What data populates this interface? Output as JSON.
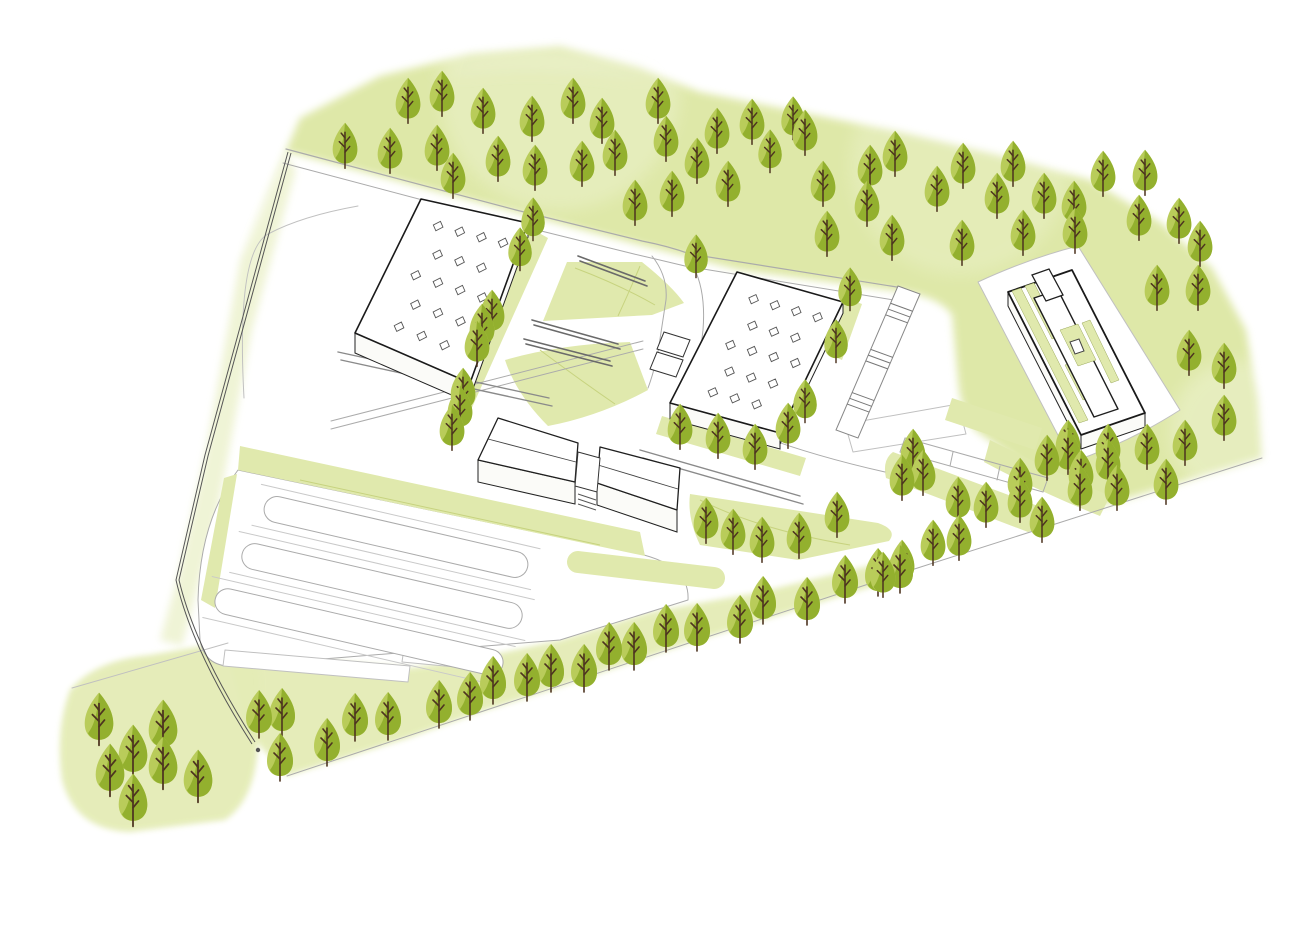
{
  "meta": {
    "kind": "architectural-site-plan",
    "view": "axonometric-illustration"
  },
  "canvas": {
    "w": 1310,
    "h": 931
  },
  "colors": {
    "bg": "#ffffff",
    "wash_deep": "#dde7a4",
    "wash_mid": "#e4ecb6",
    "wash_pale": "#eef3d2",
    "lawn": "#e0e9ad",
    "lawn_line": "#c7d37f",
    "tree_light": "#b9cc5a",
    "tree_dark": "#93b02e",
    "trunk": "#4d3420",
    "roof_outline": "#1a1a1a",
    "detail_outline": "#555555",
    "curb": "#ababab",
    "faint": "#c0c0c0",
    "platform": "#8a8a8a",
    "seat": "#6a6a6a",
    "guardrail": "#555555",
    "wall_fill": "#fbfbf8",
    "white": "#ffffff"
  },
  "washes": [
    {
      "d": "M288,152 L515,212 L640,245 L740,270 L905,292 Q940,298 952,315 L958,380 Q960,410 975,430 L1030,470 L1105,505 L1262,458 L1258,400 L1246,330 L1212,268 L1160,222 L1090,180 L1010,158 L900,132 L780,108 L700,92 L640,68 L560,46 L470,54 L380,76 L300,118 L240,258 Z",
      "fill": "wash_deep",
      "blur": "blur4",
      "op": 0.95
    },
    {
      "d": "M286,156 L240,260 L205,455 L178,575 L160,640 L182,646 L216,520 L252,330 L296,170 Z",
      "fill": "wash_pale",
      "blur": "blur4",
      "op": 0.9
    },
    {
      "d": "M227,652 L410,668 L478,658 L560,640 L650,612 L760,592 L905,557 L900,578 L695,641 L550,690 L480,712 L408,738 L287,776 L250,735 Z",
      "fill": "wash_mid",
      "blur": "blur3",
      "op": 0.95
    },
    {
      "d": "M70,690 Q95,660 150,655 L225,642 Q258,648 260,680 L258,745 Q255,800 225,820 L130,832 Q75,830 62,780 Q55,730 70,690 Z",
      "fill": "wash_mid",
      "blur": "blur3",
      "op": 0.95
    },
    {
      "d": "M430,70 Q560,40 660,80 Q560,60 470,70 Z",
      "fill": "wash_pale",
      "blur": "blur8",
      "op": 0.6
    }
  ],
  "soft_lights": [
    {
      "cx": 560,
      "cy": 90,
      "r": 120,
      "op": 0.22
    },
    {
      "cx": 960,
      "cy": 165,
      "r": 110,
      "op": 0.18
    },
    {
      "cx": 1240,
      "cy": 430,
      "r": 70,
      "op": 0.25
    }
  ],
  "white_areas": [
    {
      "d": "M238,470 L640,554 Q690,566 688,600 L560,640 L235,666 Q205,668 200,640 L198,600 Q200,520 238,470 Z",
      "stroke": "curb"
    },
    {
      "d": "M978,282 Q1030,258 1078,246 L1180,410 Q1130,442 1072,462 Z",
      "stroke": "faint"
    },
    {
      "d": "M845,424 L958,404 L966,434 L853,452 Z",
      "stroke": "faint"
    },
    {
      "d": "M225,650 L410,666 L408,682 L223,666 Z",
      "stroke": "faint"
    },
    {
      "d": "M404,648 L468,654 L466,668 L402,662 Z",
      "stroke": "faint"
    }
  ],
  "lawns": [
    {
      "d": "M567,262 L642,262 Q672,286 684,303 L652,315 L543,321 Z"
    },
    {
      "d": "M505,360 Q560,344 630,342 L648,390 Q600,416 548,426 Q516,394 505,360 Z"
    },
    {
      "d": "M690,494 L878,523 Q898,530 889,541 L798,560 L700,545 Q687,518 690,494 Z"
    },
    {
      "d": "M240,446 L640,532 L645,556 L238,470 Z"
    },
    {
      "d": "M237,474 L215,608 L201,600 L224,478 Z"
    },
    {
      "d": "M893,452 L1038,506 Q1052,513 1046,526 L1028,532 L886,478 Q882,460 893,452 Z"
    },
    {
      "d": "M952,398 L1042,428 L1035,450 L945,420 Z"
    },
    {
      "d": "M990,440 Q1050,470 1110,496 L1100,516 Q1040,492 984,462 Z"
    },
    {
      "d": "M530,228 L548,238 L470,412 L452,440 L444,432 L462,398 Z"
    },
    {
      "d": "M662,416 L806,458 L800,476 L656,434 Z"
    },
    {
      "d": "M846,298 L862,304 L842,360 L828,354 Z"
    }
  ],
  "lawn_lines": [
    {
      "d": "M575,268 Q620,285 655,305"
    },
    {
      "d": "M640,266 Q630,290 618,316"
    },
    {
      "d": "M540,350 Q580,380 615,404"
    },
    {
      "d": "M700,500 Q760,530 850,545"
    },
    {
      "d": "M300,480 L600,545"
    }
  ],
  "capsules": [
    {
      "x1": 578,
      "y1": 562,
      "x2": 714,
      "y2": 578,
      "w": 22
    }
  ],
  "parking": {
    "angle": 13,
    "islands": [
      {
        "cx": 396,
        "cy": 537,
        "len": 270,
        "w": 26
      },
      {
        "cx": 382,
        "cy": 586,
        "len": 287,
        "w": 26
      },
      {
        "cx": 359,
        "cy": 632,
        "len": 295,
        "w": 26
      }
    ],
    "aux_offset": 21
  },
  "lines": [
    {
      "d": "M286,149 L516,210 L642,241 Q668,246 690,254 L903,288",
      "c": "curb",
      "w": 1.2
    },
    {
      "d": "M283,163 L513,224 L634,254 Q660,260 685,266 L900,301",
      "c": "curb",
      "w": 1
    },
    {
      "d": "M652,256 Q668,276 666,300 L658,352 Q654,372 648,388",
      "c": "curb",
      "w": 1
    },
    {
      "d": "M694,268 Q706,292 703,330 L698,372 Q696,392 700,408",
      "c": "curb",
      "w": 1
    },
    {
      "d": "M703,410 Q770,446 885,472",
      "c": "curb",
      "w": 1
    },
    {
      "d": "M244,398 Q236,252 268,234 Q302,216 358,206",
      "c": "faint",
      "w": 1
    },
    {
      "d": "M331,421 L643,341",
      "c": "curb",
      "w": 1
    },
    {
      "d": "M331,429 L643,349",
      "c": "curb",
      "w": 1
    },
    {
      "d": "M287,776 L695,641 L905,572 L1262,458",
      "c": "curb",
      "w": 1
    },
    {
      "d": "M72,688 L228,643",
      "c": "faint",
      "w": 1
    },
    {
      "d": "M905,438 L1048,478",
      "c": "curb",
      "w": 1
    },
    {
      "d": "M900,452 L1043,492",
      "c": "curb",
      "w": 1
    },
    {
      "d": "M905,438 L900,452",
      "c": "curb",
      "w": 1
    },
    {
      "d": "M1048,478 L1043,492",
      "c": "curb",
      "w": 1
    },
    {
      "d": "M953,452 L950,466",
      "c": "curb",
      "w": 1
    },
    {
      "d": "M1000,466 L997,480",
      "c": "curb",
      "w": 1
    },
    {
      "d": "M338,352 L549,398",
      "c": "platform",
      "w": 1.4
    },
    {
      "d": "M341,360 L552,406",
      "c": "platform",
      "w": 1.4
    },
    {
      "d": "M640,450 L800,496",
      "c": "platform",
      "w": 1.4
    },
    {
      "d": "M643,458 L803,504",
      "c": "platform",
      "w": 1.4
    },
    {
      "d": "M578,256 L645,281",
      "c": "seat",
      "w": 1.6
    },
    {
      "d": "M580,261 L647,286",
      "c": "seat",
      "w": 1.6
    },
    {
      "d": "M532,320 L618,344",
      "c": "seat",
      "w": 1.6
    },
    {
      "d": "M534,325 L620,349",
      "c": "seat",
      "w": 1.6
    },
    {
      "d": "M524,339 L610,361",
      "c": "seat",
      "w": 1.6
    },
    {
      "d": "M526,344 L612,366",
      "c": "seat",
      "w": 1.6
    }
  ],
  "guardrail": {
    "paths": [
      "M288,152 L205,455 L176,580 Q192,650 252,744",
      "M291,153 L208,456 L179,580 Q195,648 255,742"
    ],
    "dot": [
      258,
      750
    ]
  },
  "ramp": {
    "quad": [
      [
        898,
        286
      ],
      [
        920,
        294
      ],
      [
        858,
        438
      ],
      [
        836,
        430
      ]
    ],
    "treads": [
      0.12,
      0.16,
      0.2,
      0.44,
      0.48,
      0.52,
      0.74,
      0.78,
      0.82
    ]
  },
  "buildings": {
    "sky_uv": [
      [
        0.25,
        0.15
      ],
      [
        0.45,
        0.15
      ],
      [
        0.65,
        0.15
      ],
      [
        0.85,
        0.15
      ],
      [
        0.35,
        0.33
      ],
      [
        0.55,
        0.33
      ],
      [
        0.75,
        0.33
      ],
      [
        0.25,
        0.5
      ],
      [
        0.45,
        0.5
      ],
      [
        0.65,
        0.5
      ],
      [
        0.85,
        0.5
      ],
      [
        0.35,
        0.68
      ],
      [
        0.55,
        0.68
      ],
      [
        0.75,
        0.68
      ],
      [
        0.3,
        0.85
      ],
      [
        0.5,
        0.85
      ],
      [
        0.7,
        0.85
      ]
    ],
    "hall_left": {
      "quad": [
        [
          421,
          199
        ],
        [
          528,
          223
        ],
        [
          470,
          383
        ],
        [
          355,
          333
        ]
      ],
      "wall": 20
    },
    "hall_middle": {
      "quad": [
        [
          737,
          272
        ],
        [
          843,
          302
        ],
        [
          780,
          433
        ],
        [
          670,
          403
        ]
      ],
      "wall": 16
    },
    "annexes": [
      [
        [
          664,
          332
        ],
        [
          690,
          340
        ],
        [
          683,
          357
        ],
        [
          657,
          349
        ]
      ],
      [
        [
          657,
          352
        ],
        [
          683,
          360
        ],
        [
          676,
          377
        ],
        [
          650,
          369
        ]
      ]
    ],
    "sheds": [
      {
        "roof": [
          [
            498,
            418
          ],
          [
            578,
            443
          ],
          [
            575,
            482
          ],
          [
            478,
            460
          ]
        ],
        "ridge": [
          [
            488,
            439
          ],
          [
            576,
            462
          ]
        ],
        "wall": 22
      },
      {
        "roof": [
          [
            600,
            447
          ],
          [
            680,
            468
          ],
          [
            677,
            510
          ],
          [
            597,
            483
          ]
        ],
        "ridge": [
          [
            598,
            465
          ],
          [
            678,
            489
          ]
        ],
        "wall": 22
      }
    ],
    "connector": {
      "quad": [
        [
          578,
          452
        ],
        [
          600,
          458
        ],
        [
          597,
          492
        ],
        [
          575,
          486
        ]
      ],
      "steps": [
        "M578,494 L596,500",
        "M578,499 L596,505",
        "M578,504 L596,510"
      ]
    },
    "right": {
      "outer": [
        [
          1008,
          292
        ],
        [
          1072,
          270
        ],
        [
          1145,
          413
        ],
        [
          1081,
          435
        ]
      ],
      "wall": 14,
      "strips": [
        [
          [
            1012,
            291
          ],
          [
            1021,
            288
          ],
          [
            1088,
            420
          ],
          [
            1079,
            423
          ]
        ],
        [
          [
            1025,
            286
          ],
          [
            1034,
            283
          ],
          [
            1061,
            336
          ],
          [
            1052,
            339
          ]
        ],
        [
          [
            1065,
            365
          ],
          [
            1074,
            362
          ],
          [
            1092,
            397
          ],
          [
            1083,
            400
          ]
        ],
        [
          [
            1044,
            290
          ],
          [
            1053,
            287
          ],
          [
            1066,
            313
          ],
          [
            1057,
            316
          ]
        ],
        [
          [
            1082,
            323
          ],
          [
            1090,
            320
          ],
          [
            1119,
            380
          ],
          [
            1111,
            383
          ]
        ]
      ],
      "volumes": [
        [
          [
            1034,
            298
          ],
          [
            1058,
            290
          ],
          [
            1118,
            409
          ],
          [
            1094,
            417
          ]
        ]
      ],
      "bar": [
        [
          1032,
          275
        ],
        [
          1049,
          269
        ],
        [
          1063,
          295
        ],
        [
          1046,
          301
        ]
      ],
      "unit": [
        [
          1070,
          342
        ],
        [
          1079,
          339
        ],
        [
          1084,
          351
        ],
        [
          1075,
          354
        ]
      ],
      "court": [
        [
          1060,
          330
        ],
        [
          1078,
          324
        ],
        [
          1096,
          360
        ],
        [
          1078,
          366
        ]
      ]
    }
  },
  "trees": {
    "items": [
      [
        345,
        155,
        0.95
      ],
      [
        390,
        160,
        0.95
      ],
      [
        408,
        110,
        0.95
      ],
      [
        437,
        157,
        0.95
      ],
      [
        442,
        103,
        0.95
      ],
      [
        453,
        185,
        0.95
      ],
      [
        483,
        120,
        0.95
      ],
      [
        498,
        168,
        0.95
      ],
      [
        532,
        128,
        0.95
      ],
      [
        535,
        177,
        0.95
      ],
      [
        573,
        110,
        0.95
      ],
      [
        582,
        173,
        0.95
      ],
      [
        602,
        130,
        0.95
      ],
      [
        615,
        162,
        0.95
      ],
      [
        635,
        212,
        0.95
      ],
      [
        658,
        110,
        0.95
      ],
      [
        666,
        148,
        0.95
      ],
      [
        672,
        203,
        0.95
      ],
      [
        697,
        170,
        0.95
      ],
      [
        717,
        140,
        0.95
      ],
      [
        728,
        193,
        0.95
      ],
      [
        752,
        131,
        0.95
      ],
      [
        770,
        160,
        0.9
      ],
      [
        793,
        127,
        0.9
      ],
      [
        805,
        142,
        0.95
      ],
      [
        823,
        193,
        0.95
      ],
      [
        827,
        243,
        0.95
      ],
      [
        867,
        213,
        0.95
      ],
      [
        870,
        177,
        0.95
      ],
      [
        892,
        247,
        0.95
      ],
      [
        895,
        163,
        0.95
      ],
      [
        937,
        198,
        0.95
      ],
      [
        962,
        252,
        0.95
      ],
      [
        963,
        175,
        0.95
      ],
      [
        997,
        205,
        0.95
      ],
      [
        1013,
        173,
        0.95
      ],
      [
        1023,
        242,
        0.95
      ],
      [
        1044,
        205,
        0.95
      ],
      [
        1074,
        213,
        0.95
      ],
      [
        1075,
        240,
        0.95
      ],
      [
        1103,
        183,
        0.95
      ],
      [
        1139,
        227,
        0.95
      ],
      [
        1145,
        182,
        0.95
      ],
      [
        1179,
        230,
        0.95
      ],
      [
        1200,
        253,
        0.95
      ],
      [
        1157,
        297,
        0.95
      ],
      [
        1198,
        297,
        0.95
      ],
      [
        1189,
        362,
        0.95
      ],
      [
        1224,
        375,
        0.95
      ],
      [
        1224,
        427,
        0.95
      ],
      [
        1185,
        452,
        0.95
      ],
      [
        1166,
        491,
        0.95
      ],
      [
        1147,
        456,
        0.95
      ],
      [
        1108,
        456,
        0.95
      ],
      [
        1117,
        497,
        0.95
      ],
      [
        1081,
        482,
        0.95
      ],
      [
        1068,
        452,
        0.95
      ],
      [
        1020,
        490,
        0.95
      ],
      [
        1047,
        467,
        0.95
      ],
      [
        696,
        265,
        0.9
      ],
      [
        850,
        298,
        0.9
      ],
      [
        836,
        350,
        0.9
      ],
      [
        680,
        436,
        0.95
      ],
      [
        718,
        445,
        0.95
      ],
      [
        755,
        456,
        0.95
      ],
      [
        788,
        435,
        0.95
      ],
      [
        805,
        410,
        0.9
      ],
      [
        533,
        228,
        0.9
      ],
      [
        520,
        258,
        0.9
      ],
      [
        492,
        322,
        0.95
      ],
      [
        482,
        336,
        0.95
      ],
      [
        477,
        353,
        0.95
      ],
      [
        463,
        400,
        0.95
      ],
      [
        460,
        418,
        0.95
      ],
      [
        452,
        437,
        0.95
      ],
      [
        706,
        530,
        0.95
      ],
      [
        733,
        541,
        0.95
      ],
      [
        762,
        549,
        0.95
      ],
      [
        799,
        545,
        0.95
      ],
      [
        837,
        524,
        0.95
      ],
      [
        900,
        579,
        1
      ],
      [
        878,
        582,
        1
      ],
      [
        845,
        589,
        1
      ],
      [
        807,
        611,
        1
      ],
      [
        763,
        610,
        1
      ],
      [
        740,
        629,
        1
      ],
      [
        697,
        637,
        1
      ],
      [
        666,
        638,
        1
      ],
      [
        634,
        656,
        1
      ],
      [
        609,
        656,
        1
      ],
      [
        584,
        678,
        1
      ],
      [
        551,
        678,
        1
      ],
      [
        527,
        687,
        1
      ],
      [
        493,
        690,
        1
      ],
      [
        470,
        706,
        1
      ],
      [
        439,
        714,
        1
      ],
      [
        388,
        726,
        1
      ],
      [
        355,
        727,
        1
      ],
      [
        327,
        752,
        1
      ],
      [
        282,
        722,
        1
      ],
      [
        280,
        767,
        1
      ],
      [
        259,
        724,
        1
      ],
      [
        99,
        730,
        1.1
      ],
      [
        110,
        781,
        1.1
      ],
      [
        133,
        762,
        1.1
      ],
      [
        133,
        811,
        1.1
      ],
      [
        163,
        737,
        1.1
      ],
      [
        163,
        774,
        1.1
      ],
      [
        198,
        787,
        1.1
      ],
      [
        902,
        487,
        0.95
      ],
      [
        913,
        461,
        0.95
      ],
      [
        923,
        482,
        0.95
      ],
      [
        958,
        509,
        0.95
      ],
      [
        986,
        514,
        0.95
      ],
      [
        1020,
        509,
        0.95
      ],
      [
        1042,
        529,
        0.95
      ],
      [
        1068,
        461,
        0.95
      ],
      [
        1080,
        497,
        0.95
      ],
      [
        1108,
        471,
        0.95
      ],
      [
        933,
        552,
        0.95
      ],
      [
        959,
        547,
        0.95
      ],
      [
        902,
        572,
        0.95
      ],
      [
        883,
        584,
        0.95
      ]
    ]
  }
}
